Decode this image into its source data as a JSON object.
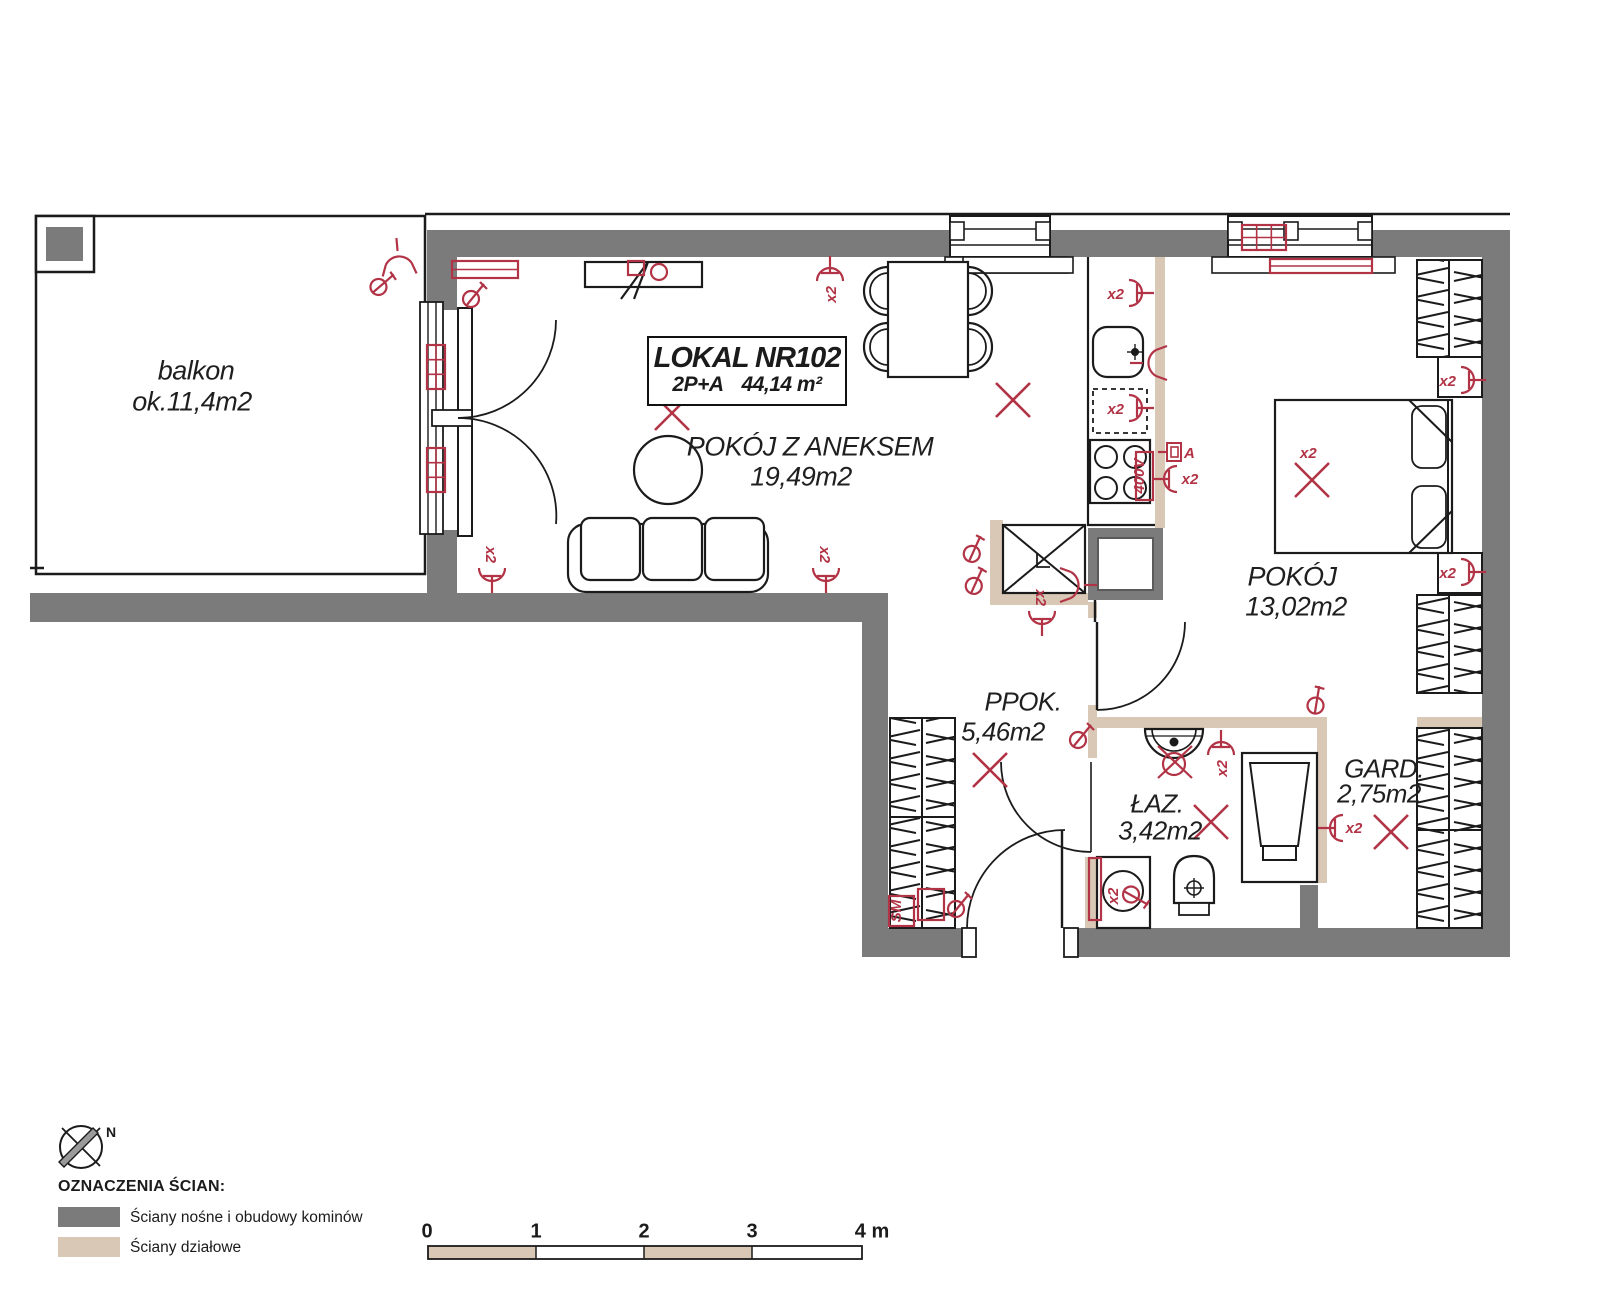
{
  "unit": {
    "number_label": "LOKAL NR102",
    "type_label": "2P+A",
    "area_label": "44,14 m²"
  },
  "rooms": [
    {
      "id": "balkon",
      "name": "balkon",
      "area": "ok.11,4m2"
    },
    {
      "id": "living",
      "name": "POKÓJ Z ANEKSEM",
      "area": "19,49m2"
    },
    {
      "id": "bedroom",
      "name": "POKÓJ",
      "area": "13,02m2"
    },
    {
      "id": "hall",
      "name": "PPOK.",
      "area": "5,46m2"
    },
    {
      "id": "bath",
      "name": "ŁAZ.",
      "area": "3,42m2"
    },
    {
      "id": "gard",
      "name": "GARD.",
      "area": "2,75m2"
    }
  ],
  "legend": {
    "heading": "OZNACZENIA ŚCIAN:",
    "items": [
      {
        "label": "Ściany nośne i obudowy kominów",
        "color": "#7b7b7b"
      },
      {
        "label": "Ściany działowe",
        "color": "#d9c8b6"
      }
    ]
  },
  "compass": {
    "label": "N"
  },
  "scalebar": {
    "ticks": [
      "0",
      "1",
      "2",
      "3",
      "4 m"
    ]
  },
  "colors": {
    "wall": "#7b7b7b",
    "partition": "#d9c8b6",
    "symbol": "#b13345",
    "line": "#1b1b1b"
  },
  "symbols": [
    {
      "type": "sconce",
      "x": 398,
      "y": 256,
      "rot": -95
    },
    {
      "type": "key",
      "x": 379,
      "y": 284,
      "rot": 10
    },
    {
      "type": "radiator",
      "x": 452,
      "y": 261,
      "w": 66,
      "h": 17
    },
    {
      "type": "key",
      "x": 471,
      "y": 296,
      "rot": 0
    },
    {
      "type": "redrect",
      "x": 628,
      "y": 261,
      "w": 16,
      "h": 14
    },
    {
      "type": "circle",
      "x": 659,
      "y": 272,
      "w": 8
    },
    {
      "type": "outlet",
      "x": 830,
      "y": 276,
      "rot": -90,
      "label": "x2"
    },
    {
      "type": "xmark",
      "x": 672,
      "y": 413,
      "label": "x2"
    },
    {
      "type": "xmark",
      "x": 1013,
      "y": 400
    },
    {
      "type": "outlet",
      "x": 1134,
      "y": 293,
      "rot": 0,
      "label": "x2"
    },
    {
      "type": "sconce",
      "x": 1148,
      "y": 363,
      "rot": 180
    },
    {
      "type": "outlet",
      "x": 1134,
      "y": 408,
      "rot": 0,
      "label": "x2"
    },
    {
      "type": "redrect",
      "x": 1136,
      "y": 452,
      "w": 17,
      "h": 48
    },
    {
      "type": "label",
      "x": 1144,
      "y": 476,
      "rot": -90,
      "label": "400V"
    },
    {
      "type": "ant",
      "x": 1174,
      "y": 452,
      "label": "A"
    },
    {
      "type": "outlet",
      "x": 1172,
      "y": 479,
      "rot": 180
    },
    {
      "type": "label",
      "x": 1190,
      "y": 484,
      "label": "x2"
    },
    {
      "type": "outlet",
      "x": 1466,
      "y": 380,
      "rot": 0,
      "label": "x2"
    },
    {
      "type": "outlet",
      "x": 1466,
      "y": 572,
      "rot": 0,
      "label": "x2"
    },
    {
      "type": "xmark",
      "x": 1312,
      "y": 480,
      "label": "x2"
    },
    {
      "type": "sash",
      "x": 1242,
      "y": 225,
      "w": 44,
      "h": 25
    },
    {
      "type": "radiator",
      "x": 1270,
      "y": 259,
      "w": 102,
      "h": 14
    },
    {
      "type": "sash",
      "x": 427,
      "y": 345,
      "w": 18,
      "h": 44
    },
    {
      "type": "sash",
      "x": 427,
      "y": 448,
      "w": 18,
      "h": 44
    },
    {
      "type": "outlet",
      "x": 492,
      "y": 573,
      "rot": 90,
      "label": "x2"
    },
    {
      "type": "outlet",
      "x": 826,
      "y": 573,
      "rot": 90,
      "label": "x2"
    },
    {
      "type": "key",
      "x": 971,
      "y": 551,
      "rot": -15
    },
    {
      "type": "key",
      "x": 973,
      "y": 583,
      "rot": -15
    },
    {
      "type": "outlet",
      "x": 1042,
      "y": 616,
      "rot": 90,
      "label": "x2"
    },
    {
      "type": "sconce",
      "x": 1079,
      "y": 585,
      "rot": 0
    },
    {
      "type": "key",
      "x": 1078,
      "y": 737,
      "rot": 0
    },
    {
      "type": "xmark",
      "x": 990,
      "y": 770
    },
    {
      "type": "key",
      "x": 1314,
      "y": 703,
      "rot": -30
    },
    {
      "type": "sinkx",
      "x": 1176,
      "y": 762
    },
    {
      "type": "outlet",
      "x": 1221,
      "y": 750,
      "rot": -90,
      "label": "x2"
    },
    {
      "type": "xmark",
      "x": 1211,
      "y": 822
    },
    {
      "type": "redrect",
      "x": 1089,
      "y": 858,
      "w": 12,
      "h": 62
    },
    {
      "type": "key",
      "x": 1134,
      "y": 894,
      "rot": 80
    },
    {
      "type": "label",
      "x": 1118,
      "y": 896,
      "rot": -90,
      "label": "x2"
    },
    {
      "type": "redrect",
      "x": 889,
      "y": 896,
      "w": 25,
      "h": 30
    },
    {
      "type": "label",
      "x": 901,
      "y": 911,
      "rot": -90,
      "label": "SM"
    },
    {
      "type": "redrect",
      "x": 918,
      "y": 889,
      "w": 26,
      "h": 31
    },
    {
      "type": "key",
      "x": 956,
      "y": 906,
      "rot": 0
    },
    {
      "type": "outlet",
      "x": 1338,
      "y": 828,
      "rot": 180
    },
    {
      "type": "label",
      "x": 1354,
      "y": 833,
      "label": "x2"
    },
    {
      "type": "xmark",
      "x": 1391,
      "y": 832
    }
  ]
}
